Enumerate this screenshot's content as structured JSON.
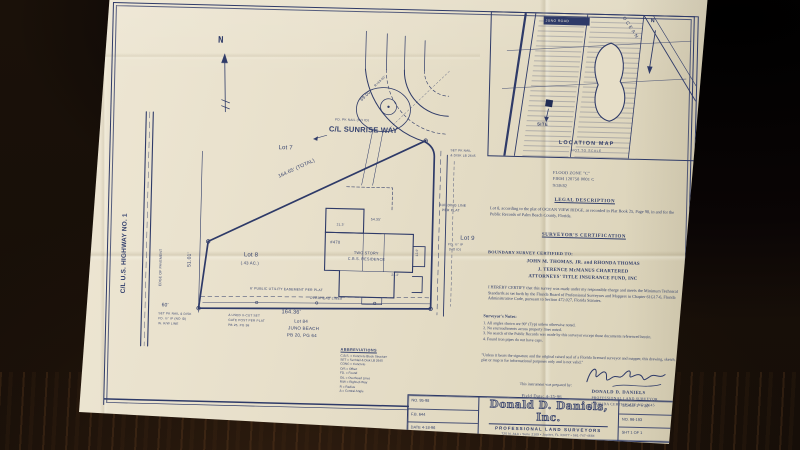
{
  "colors": {
    "ink": "#2e3a68",
    "paper": "#e8e0cb",
    "table": "#1a1109"
  },
  "plat": {
    "north_label": "N",
    "annotations": [
      {
        "t": "C/L SUNRISE WAY",
        "x": 218,
        "y": 117,
        "s": 7.5,
        "b": 1
      },
      {
        "t": "FD. PK NAIL (NO ID)",
        "x": 224,
        "y": 110,
        "s": 3.2
      },
      {
        "t": "164.65' (TOTAL)",
        "x": 168,
        "y": 168,
        "s": 5,
        "r": -26
      },
      {
        "t": "Lot 7",
        "x": 168,
        "y": 138,
        "s": 6
      },
      {
        "t": "Lot 9",
        "x": 352,
        "y": 224,
        "s": 6
      },
      {
        "t": "Lot 8",
        "x": 136,
        "y": 246,
        "s": 6
      },
      {
        "t": "(.43 AC.)",
        "x": 133,
        "y": 255,
        "s": 4.2
      },
      {
        "t": "164.36'",
        "x": 175,
        "y": 303,
        "s": 5.5
      },
      {
        "t": "60'",
        "x": 55,
        "y": 299,
        "s": 5
      },
      {
        "t": "51.01'",
        "x": 80,
        "y": 262,
        "s": 5,
        "r": -90
      },
      {
        "t": "C/L U.S. HIGHWAY NO. 1",
        "x": 14,
        "y": 290,
        "s": 6.5,
        "r": -90,
        "b": 1
      },
      {
        "t": "EDGE OF PAVEMENT",
        "x": 52,
        "y": 282,
        "s": 3.4,
        "r": -90
      },
      {
        "t": "6' PUBLIC UTILITY EASEMENT PER PLAT",
        "x": 143,
        "y": 281,
        "s": 3.4
      },
      {
        "t": "OVERHEAD LINES",
        "x": 203,
        "y": 289,
        "s": 3.4
      },
      {
        "t": "Lot 84",
        "x": 188,
        "y": 312,
        "s": 4.5
      },
      {
        "t": "JUNO BEACH",
        "x": 182,
        "y": 319,
        "s": 4.5
      },
      {
        "t": "PB 20, PG 64",
        "x": 181,
        "y": 326,
        "s": 4.5
      },
      {
        "t": "SET PK NAIL & DISK",
        "x": 52,
        "y": 308,
        "s": 3.1
      },
      {
        "t": "FD. ½\" IP (NO ID)",
        "x": 52,
        "y": 313,
        "s": 3.1
      },
      {
        "t": "W. R/W LINE",
        "x": 52,
        "y": 318,
        "s": 3.1
      },
      {
        "t": "Δ USED X-CUT SET",
        "x": 122,
        "y": 308,
        "s": 3.1
      },
      {
        "t": "GATE POST PER PLAT",
        "x": 122,
        "y": 313,
        "s": 3.1
      },
      {
        "t": "PB 25, PG 98",
        "x": 122,
        "y": 318,
        "s": 3.1
      },
      {
        "t": "TWO STORY",
        "x": 246,
        "y": 243,
        "s": 3.8
      },
      {
        "t": "C.B.S. RESIDENCE",
        "x": 240,
        "y": 249,
        "s": 3.8
      },
      {
        "t": "#470",
        "x": 222,
        "y": 232,
        "s": 4.2
      },
      {
        "t": "54.35'",
        "x": 262,
        "y": 209,
        "s": 3.4
      },
      {
        "t": "21.3'",
        "x": 228,
        "y": 215,
        "s": 3.2
      },
      {
        "t": "24.2'",
        "x": 284,
        "y": 264,
        "s": 3.2
      },
      {
        "t": "12.0'",
        "x": 308,
        "y": 246,
        "s": 3.2,
        "r": -90
      },
      {
        "t": "69.00'",
        "x": 248,
        "y": 90,
        "s": 4.5,
        "r": -45
      },
      {
        "t": "R=63.00'",
        "x": 262,
        "y": 76,
        "s": 3.2,
        "r": -45
      },
      {
        "t": "BUILDING LINE",
        "x": 330,
        "y": 193,
        "s": 3.4
      },
      {
        "t": "PER PLAT",
        "x": 333,
        "y": 198,
        "s": 3.4
      },
      {
        "t": "SET PK NAIL",
        "x": 340,
        "y": 138,
        "s": 3.1
      },
      {
        "t": "& DISK LB 2645",
        "x": 340,
        "y": 143,
        "s": 3.1
      },
      {
        "t": "FD. ½\" IP",
        "x": 340,
        "y": 232,
        "s": 3.1
      },
      {
        "t": "(NO ID)",
        "x": 341,
        "y": 237,
        "s": 3.1
      }
    ]
  },
  "location_map": {
    "title": "LOCATION MAP",
    "subtitle": "NOT TO SCALE",
    "site_label": "SITE",
    "ocean_label": "OCEAN",
    "road_label": "JUNO ROAD",
    "north_label": "N"
  },
  "flood_note": {
    "lines": [
      "FLOOD ZONE \"C\"",
      "FIRM 120758 0001 C",
      "9/30/82"
    ]
  },
  "legal": {
    "heading": "LEGAL DESCRIPTION",
    "text": "Lot 8, according to the plat of OCEAN VIEW RIDGE, as recorded in Plat Book 25, Page 98, in and for the Public Records of Palm Beach County, Florida."
  },
  "certification": {
    "heading": "SURVEYOR'S CERTIFICATION",
    "certified_to_label": "BOUNDARY SURVEY CERTIFIED TO:",
    "certified_names": [
      "JOHN M. THOMAS, JR. and RHONDA THOMAS",
      "J. TERENCE McMANUS CHARTERED",
      "ATTORNEYS' TITLE INSURANCE FUND, INC"
    ],
    "certify_text": "I HEREBY CERTIFY that this survey was made under my responsible charge and meets the Minimum Technical Standards as set forth by the Florida Board of Professional Surveyors and Mappers in Chapter 61G17-6, Florida Administrative Code, pursuant to Section 472.027, Florida Statutes."
  },
  "notes": {
    "heading": "Surveyor's Notes:",
    "items": [
      "1. All angles shown are 90° (Typ) unless otherwise noted.",
      "2. No encroachments across property lines noted.",
      "3. No search of the Public Records was made by this surveyor except those documents referenced herein.",
      "4. Found iron pipes do not have caps."
    ],
    "disclaimer": "\"Unless it bears the signature and the original raised seal of a Florida licensed surveyor and mapper, this drawing, sketch, plat or map is for informational purposes only and is not valid.\""
  },
  "signature": {
    "prepared_by": "This instrument was prepared by:",
    "field_date": "Field Date: 4-15-96",
    "surveyor_name": "DONALD D. DANIELS",
    "surveyor_title": "PROFESSIONAL LAND SURVEYOR",
    "certificate": "FLORIDA CERTIFICATE NO. 2645"
  },
  "title_block": {
    "left_rows": [
      "NO. 95-98",
      "F.B. 644",
      "DATE 4-18-96"
    ],
    "company": "Donald D. Daniels, Inc.",
    "company_sub": "PROFESSIONAL LAND SURVEYORS",
    "address": "725 N. A1A  •  Suite 2109  •  Jupiter, FL 33477  •  561-747-4684",
    "right_rows": [
      "SCALE 1\" = 30'",
      "NO. 96-193",
      "SHT 1 OF 1"
    ]
  },
  "abbreviations": {
    "heading": "ABBREVIATIONS",
    "items": [
      "C.B.S. = Concrete Block Structure",
      "SET = Set Nail & Disk LB 2645",
      "CONC = Concrete",
      "O/S = Offset",
      "FD. = Found",
      "O/L = Overhead Lines",
      "R/W = Right-of-Way",
      "R = Radius",
      "Δ = Central Angle"
    ]
  }
}
